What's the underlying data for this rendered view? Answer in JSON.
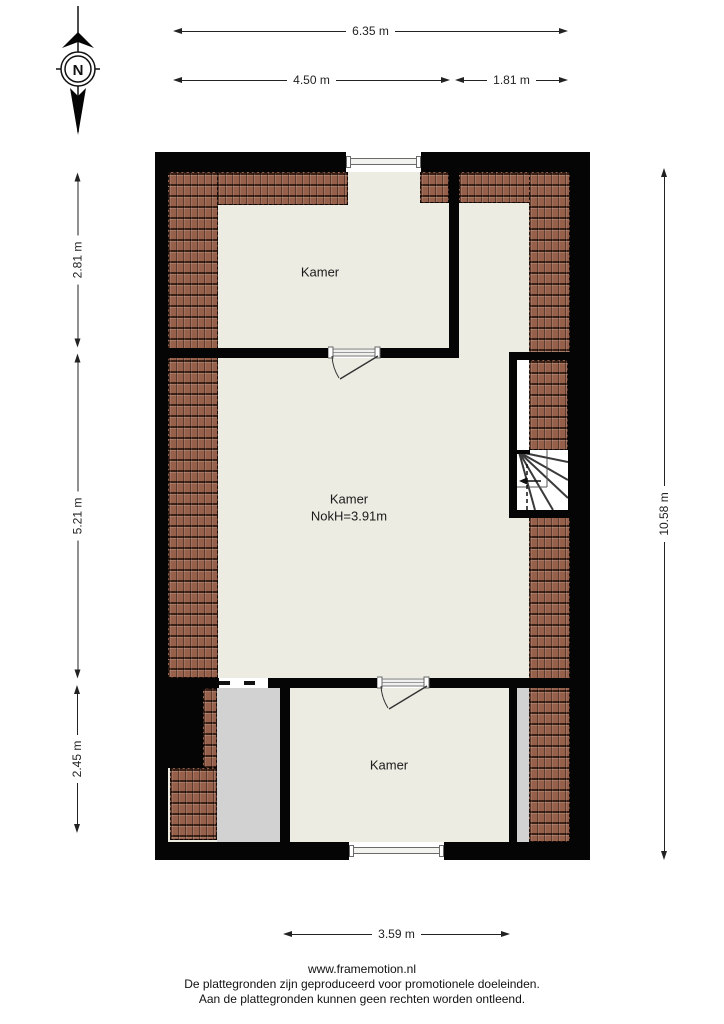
{
  "compass": {
    "north_label": "N"
  },
  "dimensions": {
    "top_total": "6.35 m",
    "top_left": "4.50 m",
    "top_right": "1.81 m",
    "left_top": "2.81 m",
    "left_middle": "5.21 m",
    "left_bottom": "2.45 m",
    "right_total": "10.58 m",
    "bottom": "3.59 m"
  },
  "rooms": {
    "top": {
      "label": "Kamer"
    },
    "middle": {
      "label": "Kamer",
      "ridge_height": "NokH=3.91m"
    },
    "bottom": {
      "label": "Kamer"
    }
  },
  "footer": {
    "website": "www.framemotion.nl",
    "disclaimer1": "De plattegronden zijn geproduceerd voor promotionele doeleinden.",
    "disclaimer2": "Aan de plattegronden kunnen geen rechten worden ontleend."
  },
  "colors": {
    "wall": "#050505",
    "floor": "#edece3",
    "roof_tile": "#96604b",
    "storage_gray": "#d2d2d2"
  }
}
